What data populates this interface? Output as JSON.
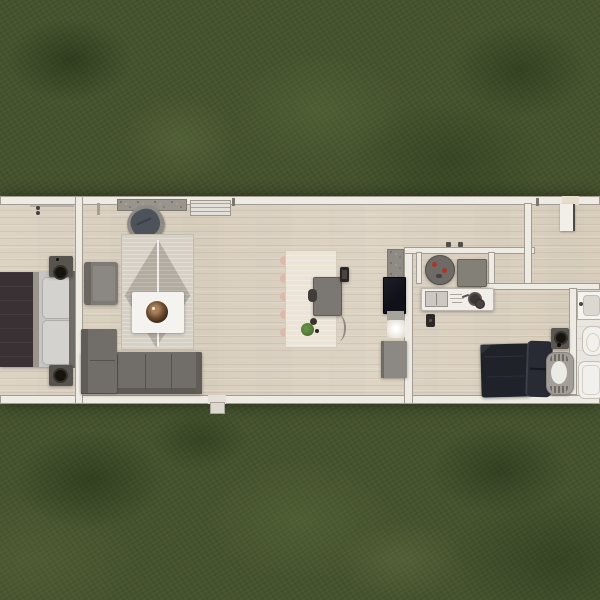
{
  "scene": {
    "type": "home floor plan render, top-down view",
    "description": "Long single-story home floor plan viewed from above, surrounded by grass lawn",
    "text_content": "none visible",
    "aria": "Top-down floor plan of a long narrow home on a grass lawn"
  },
  "palette": {
    "grass-base": "#46532e",
    "floor-wood": "#e0d7c7",
    "wall-fill": "#eeebe4",
    "wall-edge": "#a29c92",
    "tile": "#e9e6e1",
    "sofa-gray": "#716d69",
    "rug-light": "#d7d1c5",
    "rug-pattern": "#b2aba0",
    "bed1-duvet": "#393134",
    "bed2-duvet": "#20222a",
    "white-furniture": "#f5f3ef",
    "counter-white": "#f1eee9",
    "dark-gray": "#57534e",
    "red-accent": "#a8362c",
    "plant-green": "#527a36",
    "tray-brown": "#6b4a2e"
  },
  "rooms": {
    "bedroom1": {
      "label": "Bedroom (left)",
      "items": [
        "double bed with dark duvet and light gray pillows",
        "nightstand with black lamp (top)",
        "nightstand with black lamp (bottom)",
        "window marks on top wall"
      ]
    },
    "living_room": {
      "label": "Living room",
      "items": [
        "stone hearth strip on top wall",
        "white slatted console",
        "swivel armchair with dark cushion",
        "woven rug with diamond pattern",
        "white coffee table with round wooden tray",
        "square gray armchair",
        "L-shaped gray sectional sofa"
      ]
    },
    "dining_area": {
      "label": "Dining / work area",
      "items": [
        "long light table with blush chair backs",
        "gray table",
        "dark chair",
        "small dark frame",
        "potted plant",
        "arc floor lamp"
      ]
    },
    "kitchen": {
      "label": "Kitchen",
      "items": [
        "granite counter",
        "black cooktop",
        "counter segment",
        "sink with bright glow",
        "gray cabinet",
        "round bistro table with red plates",
        "gray side table",
        "island counter with sink, utensils and pots",
        "two pendant dots",
        "small dark bin"
      ]
    },
    "entry": {
      "label": "Entry",
      "items": [
        "front door opening in top wall",
        "open door leaf"
      ]
    },
    "bedroom2": {
      "label": "Bedroom (right)",
      "items": [
        "double bed with dark navy duvet and pillows",
        "nightstand with black lamp",
        "bassinet with white oval mattress"
      ]
    },
    "bathroom": {
      "label": "Bathroom (right edge, partially cut off)",
      "items": [
        "vanity with sink",
        "toilet",
        "bathtub"
      ]
    },
    "exterior": {
      "label": "Exterior",
      "items": [
        "grass lawn",
        "door step below bottom wall"
      ]
    }
  }
}
